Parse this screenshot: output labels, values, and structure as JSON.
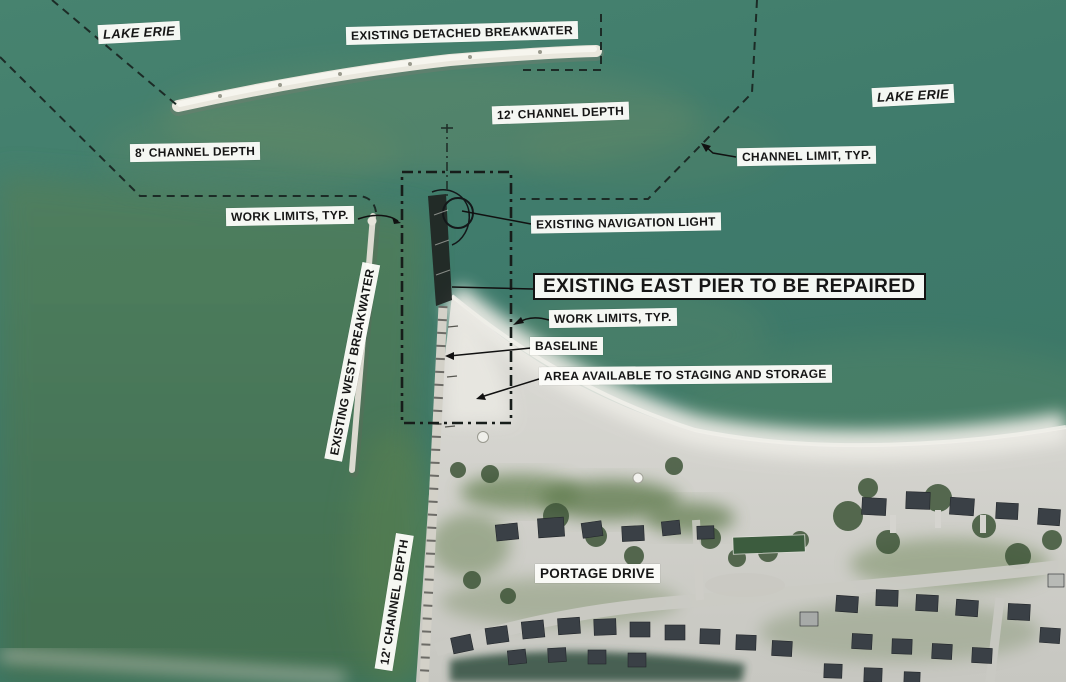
{
  "map": {
    "type": "aerial-construction-plan",
    "water_body_label": "LAKE ERIE",
    "colors": {
      "water_teal": "#3E7A6B",
      "water_olive": "#4C7A57",
      "channel_green": "#5D8450",
      "sand_beach": "#D6D4CE",
      "label_background": "#FCFCF9",
      "label_text": "#161616",
      "plan_line": "#1C2B26"
    }
  },
  "labels": {
    "lake_erie_left": "LAKE ERIE",
    "existing_detached_breakwater": "EXISTING DETACHED BREAKWATER",
    "lake_erie_right": "LAKE ERIE",
    "channel_depth_12_top": "12' CHANNEL DEPTH",
    "channel_limit_typ": "CHANNEL LIMIT, TYP.",
    "channel_depth_8": "8' CHANNEL DEPTH",
    "work_limits_typ_left": "WORK LIMITS, TYP.",
    "existing_navigation_light": "EXISTING NAVIGATION LIGHT",
    "existing_east_pier": "EXISTING EAST PIER TO BE REPAIRED",
    "work_limits_typ_center": "WORK LIMITS, TYP.",
    "baseline": "BASELINE",
    "staging_area": "AREA AVAILABLE TO STAGING AND STORAGE",
    "existing_west_breakwater": "EXISTING WEST BREAKWATER",
    "channel_depth_12_bottom": "12' CHANNEL DEPTH",
    "portage_drive": "PORTAGE DRIVE"
  }
}
